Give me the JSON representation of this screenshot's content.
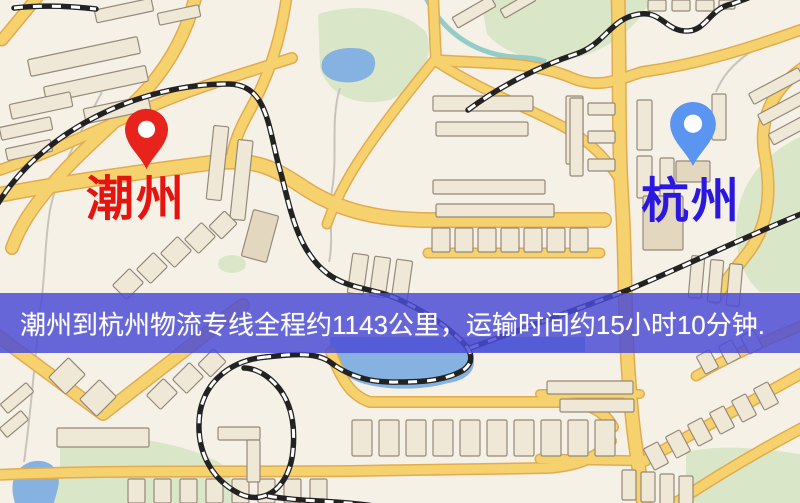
{
  "banner": {
    "text": "潮州到杭州物流专线全程约1143公里，运输时间约15小时10分钟."
  },
  "route_info": {
    "origin_city": "潮州",
    "destination_city": "杭州",
    "distance_km": "1143",
    "duration": "15小时10分钟"
  },
  "markers": {
    "origin": {
      "label": "潮州",
      "pin_color": "#e8231c",
      "label_color": "#e6140e"
    },
    "destination": {
      "label": "杭州",
      "pin_color": "#5a95f2",
      "label_color": "#2a17e0"
    }
  },
  "map_colors": {
    "background": "#f6f1e7",
    "road_fill": "#f6d26e",
    "road_casing": "#e2ab50",
    "park_green": "#d9e7c8",
    "water_blue": "#85b2e0",
    "river_teal": "#96ccc8",
    "building_fill": "#f0e8d6",
    "building_stroke": "#95897a",
    "railway_dark": "#222222",
    "banner_bg": "rgba(75,75,214,0.84)",
    "banner_text": "#ffffff"
  }
}
